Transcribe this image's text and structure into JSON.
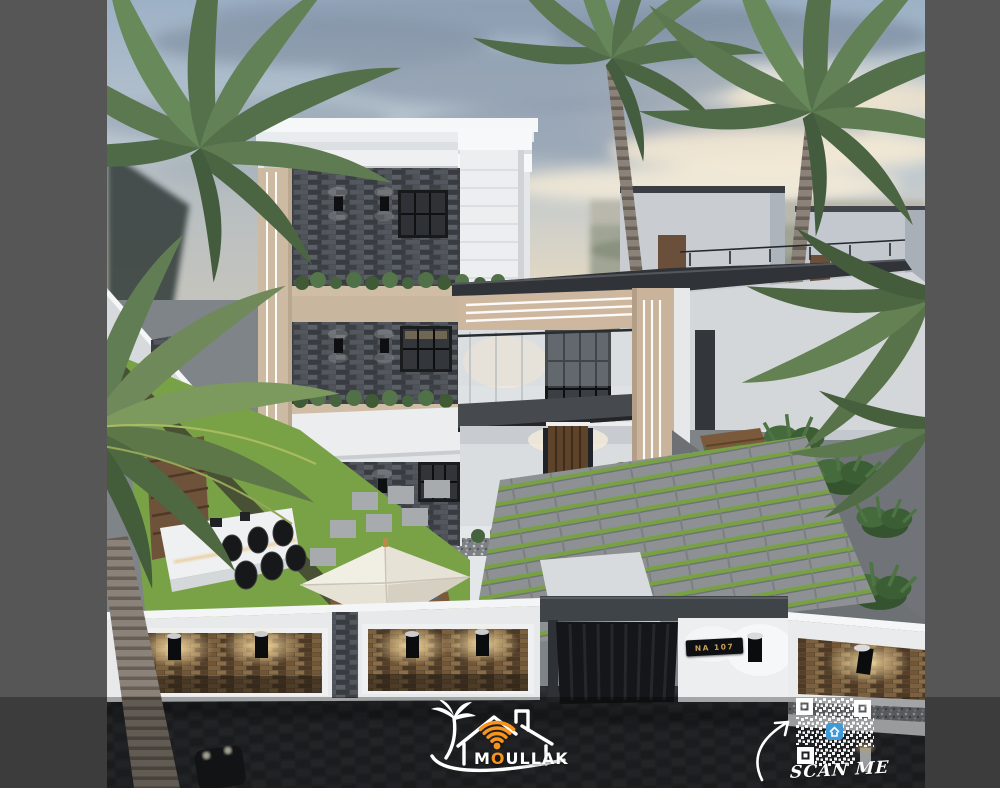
{
  "branding": {
    "name": "MOULLAK",
    "wordmark_prefix": "M",
    "wordmark_accent": "O",
    "wordmark_suffix": "ULLAK",
    "icon": "palm-house-wifi-icon",
    "accent_color": "#F7941D",
    "wordmark_color": "#FFFFFF"
  },
  "qr_block": {
    "label": "SCAN ME",
    "icon": "qr-code-icon",
    "arrow_icon": "curved-arrow-icon",
    "module_color": "#FFFFFF",
    "center_badge_color": "#3F9BD8"
  },
  "house": {
    "number_plate": "NA 107",
    "plate_text_color": "#C9A05C",
    "plate_background": "#0E0F12"
  },
  "palette": {
    "letterbox": "#565656",
    "sky_top": "#9DB1C6",
    "sky_warm": "#F2E2C6",
    "cloud_slate": "#8493A6",
    "stone_slate": "#45494E",
    "facade_white": "#ECEEF0",
    "facade_beige": "#CDB79E",
    "lawn_green": "#79A246",
    "street_dark": "#2B2D2F",
    "lit_stone_warm": "#8A6D49",
    "overlay_band": "rgba(0,0,0,0.30)"
  }
}
